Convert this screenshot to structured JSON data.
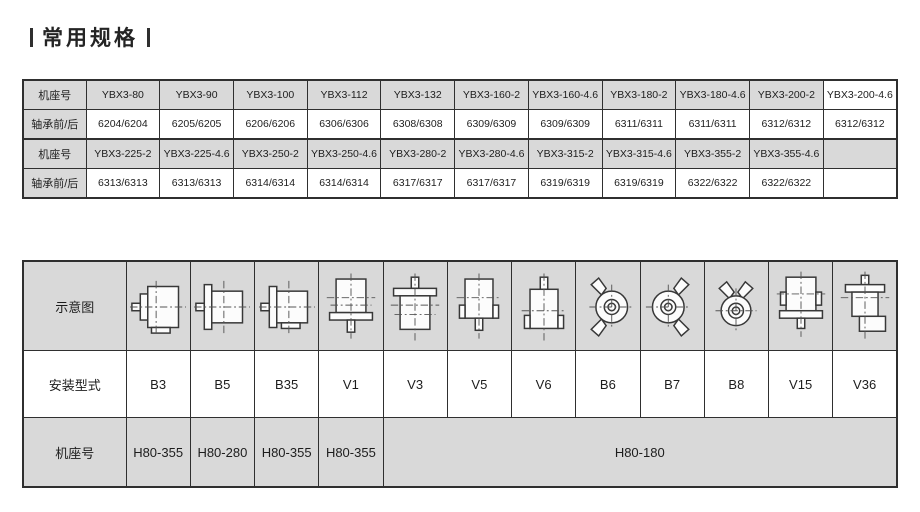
{
  "page": {
    "title": "常用规格"
  },
  "colors": {
    "cell_fill": "#d9d9d9",
    "border": "#2f2f2f",
    "text": "#1d1d1d"
  },
  "bearing_table": {
    "frame_label": "机座号",
    "bearing_label": "轴承前/后",
    "group1": {
      "frames": [
        "YBX3-80",
        "YBX3-90",
        "YBX3-100",
        "YBX3-112",
        "YBX3-132",
        "YBX3-160-2",
        "YBX3-160-4.6",
        "YBX3-180-2",
        "YBX3-180-4.6",
        "YBX3-200-2",
        "YBX3-200-4.6"
      ],
      "bearings": [
        "6204/6204",
        "6205/6205",
        "6206/6206",
        "6306/6306",
        "6308/6308",
        "6309/6309",
        "6309/6309",
        "6311/6311",
        "6311/6311",
        "6312/6312",
        "6312/6312"
      ]
    },
    "group2": {
      "frames": [
        "YBX3-225-2",
        "YBX3-225-4.6",
        "YBX3-250-2",
        "YBX3-250-4.6",
        "YBX3-280-2",
        "YBX3-280-4.6",
        "YBX3-315-2",
        "YBX3-315-4.6",
        "YBX3-355-2",
        "YBX3-355-4.6",
        ""
      ],
      "bearings": [
        "6313/6313",
        "6313/6313",
        "6314/6314",
        "6314/6314",
        "6317/6317",
        "6317/6317",
        "6319/6319",
        "6319/6319",
        "6322/6322",
        "6322/6322",
        ""
      ]
    }
  },
  "mounting_table": {
    "diagram_label": "示意图",
    "type_label": "安装型式",
    "frame_label": "机座号",
    "types": [
      "B3",
      "B5",
      "B35",
      "V1",
      "V3",
      "V5",
      "V6",
      "B6",
      "B7",
      "B8",
      "V15",
      "V36"
    ],
    "frames_individual": [
      "H80-355",
      "H80-280",
      "H80-355",
      "H80-355"
    ],
    "frame_merged": "H80-180"
  }
}
